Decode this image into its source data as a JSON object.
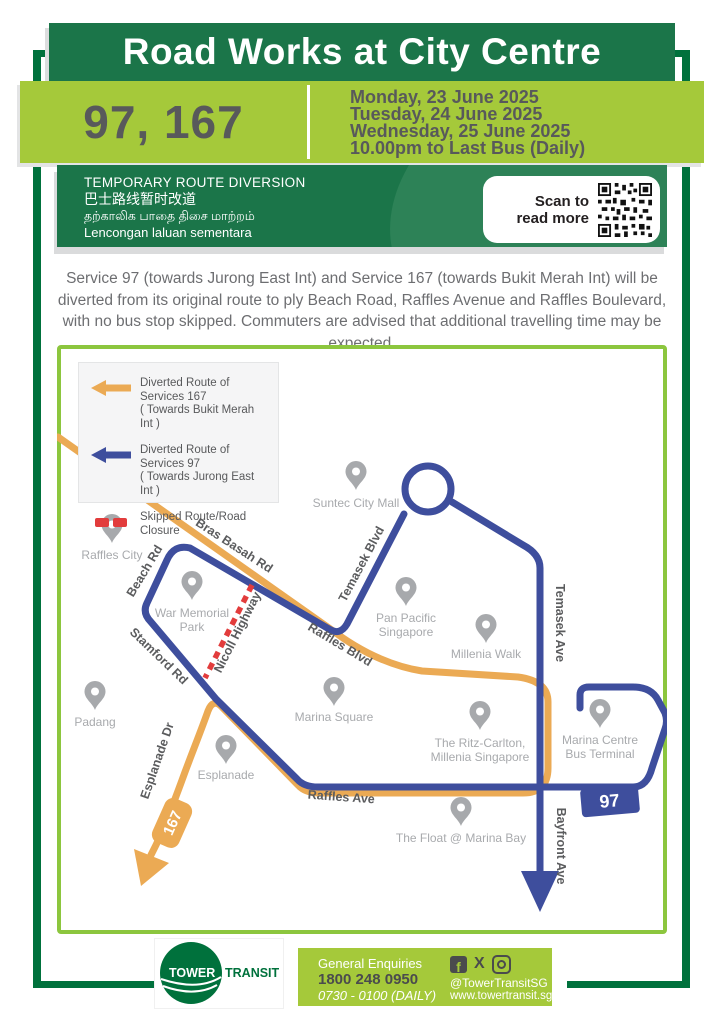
{
  "colors": {
    "brand_green": "#1B7549",
    "frame_green": "#00713C",
    "light_green": "#A5C93A",
    "map_border_green": "#8CC63E",
    "route_97_blue": "#3E4E9D",
    "route_167_orange": "#EBAA54",
    "closure_red": "#E23C3C",
    "text_dark_gray": "#58595B",
    "map_gray": "#A7A9AC"
  },
  "header": {
    "title": "Road Works at City Centre",
    "services": "97, 167",
    "dates": [
      "Monday, 23 June 2025",
      "Tuesday, 24 June 2025",
      "Wednesday, 25 June 2025",
      "10.00pm to Last Bus (Daily)"
    ]
  },
  "notice": {
    "line_en": "TEMPORARY ROUTE DIVERSION",
    "line_zh": "巴士路线暂时改道",
    "line_ta": "தற்காலிக பாதை திசை மாற்றம்",
    "line_ms": "Lencongan laluan sementara",
    "scan_line1": "Scan to",
    "scan_line2": "read more"
  },
  "description": "Service 97 (towards Jurong East Int) and Service 167 (towards Bukit Merah Int) will be diverted from its original route to ply Beach Road, Raffles Avenue and Raffles Boulevard, with no bus stop skipped. Commuters are advised that additional travelling time may be expected.",
  "legend": {
    "items": [
      {
        "line1": "Diverted Route of Services 167",
        "line2": "( Towards Bukit Merah Int )"
      },
      {
        "line1": "Diverted Route of Services 97",
        "line2": "( Towards Jurong East Int )"
      },
      {
        "line1": "Skipped Route/Road Closure",
        "line2": ""
      }
    ]
  },
  "map": {
    "roads": {
      "bras_basah": "Bras Basah Rd",
      "beach": "Beach Rd",
      "stamford": "Stamford Rd",
      "nicoll": "Nicoll Highway",
      "raffles_blvd": "Raffles Blvd",
      "temasek_blvd": "Temasek Blvd",
      "temasek_ave": "Temasek Ave",
      "raffles_ave": "Raffles Ave",
      "esplanade_dr": "Esplanade Dr",
      "bayfront_ave": "Bayfront Ave"
    },
    "places": {
      "suntec": {
        "l1": "Suntec City Mall"
      },
      "raffles_city": {
        "l1": "Raffles City"
      },
      "war_memorial": {
        "l1": "War Memorial",
        "l2": "Park"
      },
      "pan_pacific": {
        "l1": "Pan Pacific",
        "l2": "Singapore"
      },
      "millenia_walk": {
        "l1": "Millenia Walk"
      },
      "padang": {
        "l1": "Padang"
      },
      "marina_square": {
        "l1": "Marina Square"
      },
      "esplanade": {
        "l1": "Esplanade"
      },
      "ritz": {
        "l1": "The Ritz-Carlton,",
        "l2": "Millenia Singapore"
      },
      "marina_centre": {
        "l1": "Marina Centre",
        "l2": "Bus Terminal"
      },
      "float": {
        "l1": "The Float @ Marina Bay"
      }
    },
    "badges": {
      "s167": "167",
      "s97": "97"
    }
  },
  "footer": {
    "logo_word1": "TOWER",
    "logo_word2": "TRANSIT",
    "enquiries_label": "General Enquiries",
    "phone": "1800 248 0950",
    "hours": "0730 - 0100 (DAILY)",
    "handle": "@TowerTransitSG",
    "website": "www.towertransit.sg"
  }
}
